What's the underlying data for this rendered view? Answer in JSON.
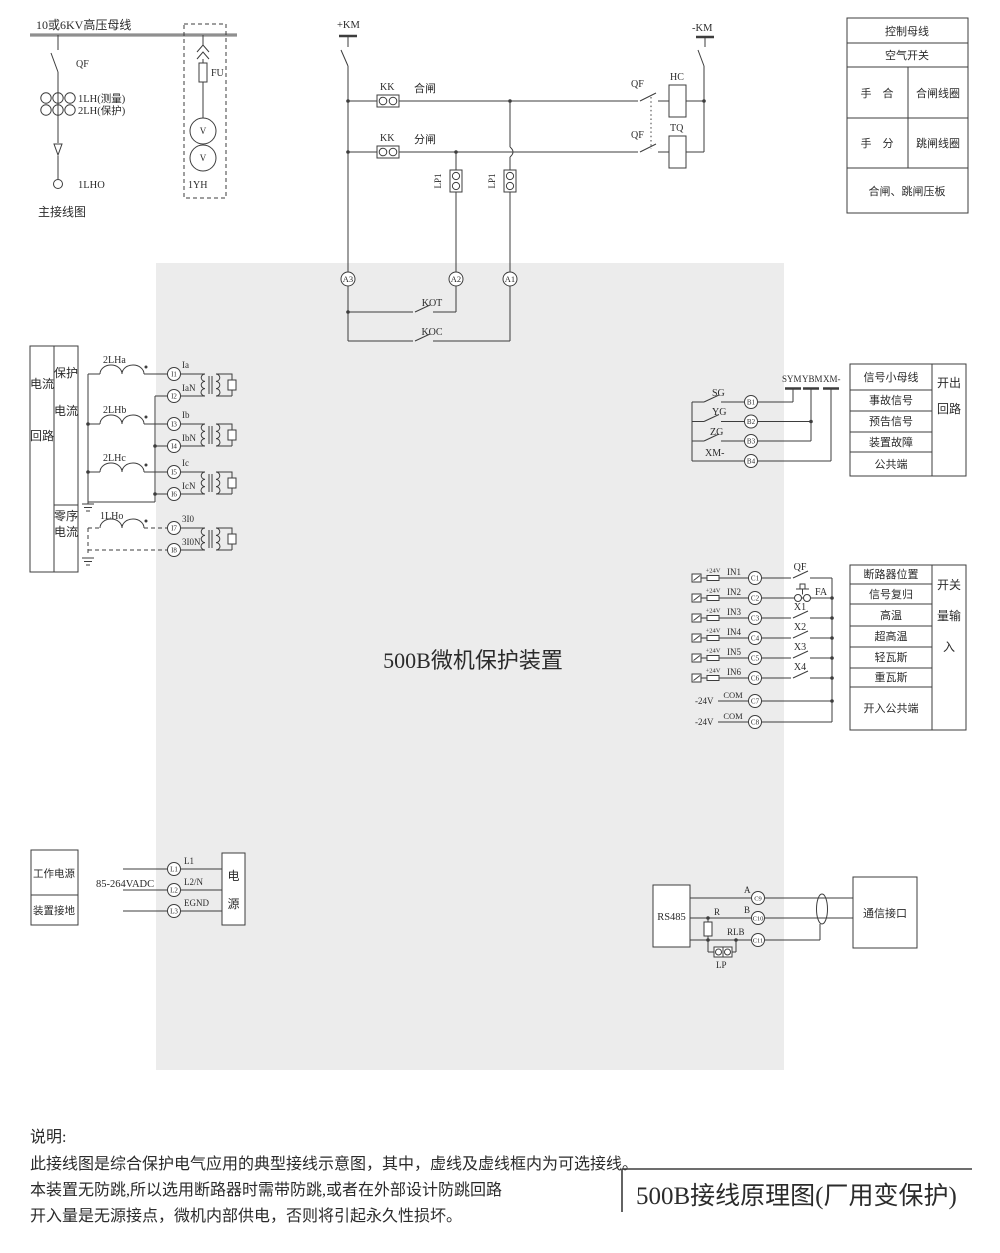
{
  "colors": {
    "background": "#ffffff",
    "device_fill": "#ececec",
    "line": "#3d3d3d",
    "text": "#2b2b2b",
    "bus": "#8f8f8f"
  },
  "main_diagram": {
    "bus": "10或6KV高压母线",
    "qf": "QF",
    "ct_measure": "1LH(测量)",
    "ct_protect": "2LH(保护)",
    "ct_zero": "1LHO",
    "caption": "主接线图",
    "fuse": "FU",
    "pt": "1YH",
    "volt": "V"
  },
  "control": {
    "plus_km": "+KM",
    "minus_km": "-KM",
    "kk": "KK",
    "close_label": "合闸",
    "trip_label": "分闸",
    "qf": "QF",
    "hc": "HC",
    "tq": "TQ",
    "lp1": "LP1",
    "a3": "A3",
    "a2": "A2",
    "a1": "A1",
    "kot": "KOT",
    "koc": "KOC"
  },
  "legend": {
    "row1": "控制母线",
    "row2": "空气开关",
    "manual_close": "手　合",
    "close_coil": "合闸线圈",
    "manual_trip": "手　分",
    "trip_coil": "跳闸线圈",
    "footer": "合闸、跳闸压板"
  },
  "device": {
    "name": "500B微机保护装置"
  },
  "current": {
    "group": "电流回路",
    "protect": "保护电流",
    "zero": "零序电流",
    "ct": [
      "2LHa",
      "2LHb",
      "2LHc",
      "1LHo"
    ],
    "terms": [
      {
        "id": "I1",
        "label": "Ia"
      },
      {
        "id": "I2",
        "label": "IaN"
      },
      {
        "id": "I3",
        "label": "Ib"
      },
      {
        "id": "I4",
        "label": "IbN"
      },
      {
        "id": "I5",
        "label": "Ic"
      },
      {
        "id": "I6",
        "label": "IcN"
      },
      {
        "id": "I7",
        "label": "3I0"
      },
      {
        "id": "I8",
        "label": "3I0N"
      }
    ]
  },
  "signal": {
    "buses": [
      "SYM",
      "YBM",
      "XM-"
    ],
    "rows": [
      {
        "name": "SG",
        "term": "B1"
      },
      {
        "name": "YG",
        "term": "B2"
      },
      {
        "name": "ZG",
        "term": "B3"
      },
      {
        "name": "XM-",
        "term": "B4"
      }
    ],
    "table": [
      "信号小母线",
      "事故信号",
      "预告信号",
      "装置故障",
      "公共端"
    ],
    "side": "开出回路"
  },
  "inputs": {
    "v24": "+24V",
    "minus24": "-24V",
    "com": "COM",
    "c7": "C7",
    "c8": "C8",
    "rows": [
      {
        "name": "IN1",
        "term": "C1",
        "ext": "QF"
      },
      {
        "name": "IN2",
        "term": "C2",
        "ext": "FA"
      },
      {
        "name": "IN3",
        "term": "C3",
        "ext": "X1"
      },
      {
        "name": "IN4",
        "term": "C4",
        "ext": "X2"
      },
      {
        "name": "IN5",
        "term": "C5",
        "ext": "X3"
      },
      {
        "name": "IN6",
        "term": "C6",
        "ext": "X4"
      }
    ],
    "table": [
      "断路器位置",
      "信号复归",
      "高温",
      "超高温",
      "轻瓦斯",
      "重瓦斯",
      "开入公共端"
    ],
    "side": "开关量输入"
  },
  "power": {
    "row1": "工作电源",
    "row2": "装置接地",
    "range": "85-264VADC",
    "terms": [
      {
        "id": "L1",
        "label": "L1"
      },
      {
        "id": "L2",
        "label": "L2/N"
      },
      {
        "id": "L3",
        "label": "EGND"
      }
    ],
    "box": "电源"
  },
  "comm": {
    "box": "RS485",
    "r": "R",
    "lp": "LP",
    "terms": [
      {
        "id": "C9",
        "label": "A"
      },
      {
        "id": "C10",
        "label": "B"
      },
      {
        "id": "C11",
        "label": "RLB"
      }
    ],
    "iface": "通信接口"
  },
  "notes": {
    "head": "说明:",
    "l1": "此接线图是综合保护电气应用的典型接线示意图，其中，虚线及虚线框内为可选接线。",
    "l2": "本装置无防跳,所以选用断路器时需带防跳,或者在外部设计防跳回路",
    "l3": "开入量是无源接点，微机内部供电，否则将引起永久性损坏。"
  },
  "title": "500B接线原理图(厂用变保护)"
}
